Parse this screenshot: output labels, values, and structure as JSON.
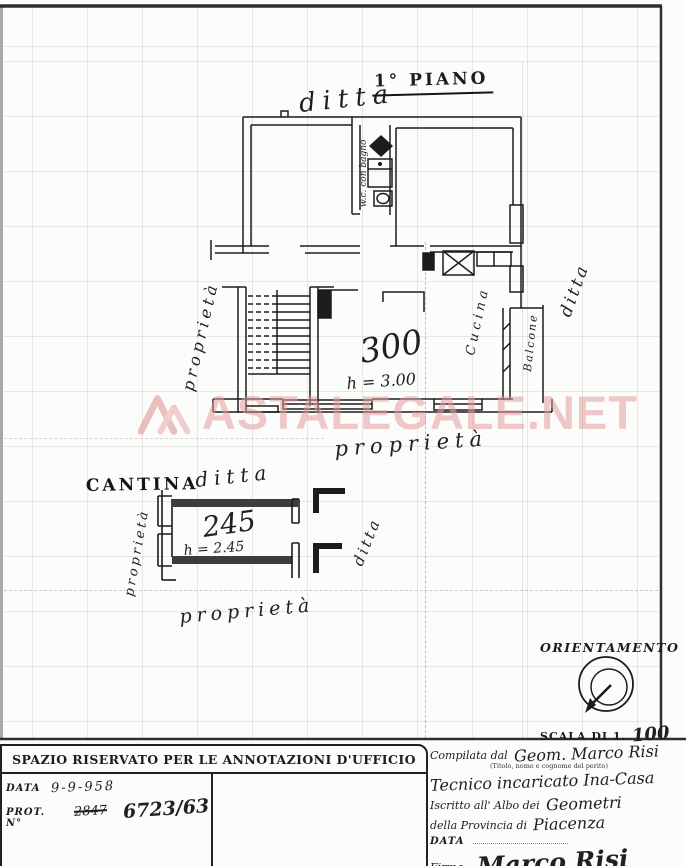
{
  "document": {
    "floor_title": "1° PIANO",
    "watermark_text": "ASTALEGALE.NET"
  },
  "piano": {
    "ditta_top": "ditta",
    "wc_label": "w.c. con bagno",
    "room_area": "300",
    "room_height": "h = 3.00",
    "kitchen_label": "Cucina",
    "balcony_label": "Balcone",
    "proprieta_left": "proprietà",
    "ditta_right": "ditta",
    "proprieta_bottom": "proprietà"
  },
  "cantina": {
    "title": "CANTINA",
    "ditta_top": "ditta",
    "room_area": "245",
    "room_height": "h = 2.45",
    "ditta_right": "ditta",
    "proprieta_left": "proprietà",
    "proprieta_bottom": "proprietà"
  },
  "orientation": {
    "title": "ORIENTAMENTO",
    "scale_label": "SCALA DI 1.",
    "scale_value": "100"
  },
  "annotations": {
    "header": "SPAZIO RISERVATO PER LE ANNOTAZIONI D'UFFICIO",
    "data_label": "DATA",
    "data_value": "9-9-958",
    "prot_label": "PROT. N°",
    "prot_old": "2847",
    "prot_new": "6723/63"
  },
  "compiler": {
    "compilata_label": "Compilata dal",
    "compilata_value": "Geom. Marco Risi",
    "caption": "(Titolo, nome e cognome del perito)",
    "role_value": "Tecnico incaricato Ina-Casa",
    "albo_label": "Iscritto all' Albo dei",
    "albo_value": "Geometri",
    "provincia_label": "della Provincia di",
    "provincia_value": "Piacenza",
    "data_label": "DATA",
    "firma_label": "Firma:",
    "firma_value": "Marco Risi"
  },
  "colors": {
    "ink": "#1c1c1c",
    "paper": "#fcfcfa",
    "watermark_pink": "#e29e9e",
    "grid_gray": "#7d7d7d"
  }
}
